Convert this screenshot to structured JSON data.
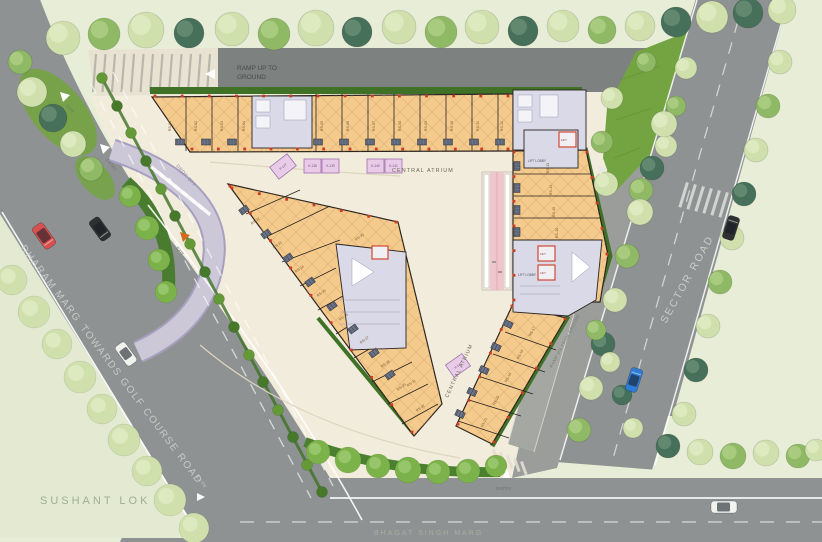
{
  "labels": {
    "ramp_up_line1": "RAMP UP TO",
    "ramp_up_line2": "GROUND",
    "ramp_dn": "RAMP DN FROM GROUND",
    "central_atrium_top": "CENTRAL ATRIUM",
    "central_atrium_mid": "CENTRAL ATRIUM",
    "dharam_marg": "DHARAM MARG",
    "towards_golf": "TOWARDS GOLF COURSE ROAD",
    "road_extn": "EXTN",
    "sector_road": "SECTOR ROAD",
    "sushant_lok": "SUSHANT LOK",
    "bhagat_singh_marg": "BHAGAT SINGH MARG",
    "drop_off": "DROP OFF",
    "entry_left": "ENTRY",
    "exit_top": "EXIT",
    "exit_drop": "EXIT",
    "entry_bottom": "ENTRY",
    "lift_lobby_right": "LIFT LOBBY",
    "lift_lobby_top": "LIFT LOBBY",
    "lift": "LIFT"
  },
  "colors": {
    "road_grey": "#8f9292",
    "road_dark": "#7d8180",
    "paving_cream": "#f2ecdc",
    "pale_green": "#e8edd8",
    "lawn_green": "#74a441",
    "hedge_green": "#3f7227",
    "shop_tan": "#f4ca8d",
    "core_lavender": "#d9d9e7",
    "kiosk_pink": "#e8cbe6",
    "escalator_pink": "#eec6cb",
    "dropoff_lavender": "#ccc8d8",
    "accent_red": "#cf3b23",
    "tones": {
      "pale": [
        "#cfe0ad",
        "#e2edc6"
      ],
      "light": [
        "#b7d38c",
        "#d3e5af"
      ],
      "mid": [
        "#8fb964",
        "#b1d28a"
      ],
      "dark": [
        "#5d8a50",
        "#7fa973"
      ],
      "teal": [
        "#47705a",
        "#6b9178"
      ],
      "bright": [
        "#7cb24a",
        "#a3cd79"
      ]
    },
    "median_bush_a": "#47792b",
    "median_bush_b": "#639a37"
  },
  "scene": {
    "units": [
      {
        "label": "RS-01",
        "x": 171,
        "y": 126,
        "rot": -90
      },
      {
        "label": "RS-02",
        "x": 197,
        "y": 126,
        "rot": -90
      },
      {
        "label": "RS-03",
        "x": 223,
        "y": 126,
        "rot": -90
      },
      {
        "label": "RS-04",
        "x": 245,
        "y": 126,
        "rot": -90
      },
      {
        "label": "RS-05",
        "x": 323,
        "y": 126,
        "rot": -90
      },
      {
        "label": "RS-06",
        "x": 349,
        "y": 126,
        "rot": -90
      },
      {
        "label": "RS-07",
        "x": 375,
        "y": 126,
        "rot": -90
      },
      {
        "label": "RS-08",
        "x": 401,
        "y": 126,
        "rot": -90
      },
      {
        "label": "RS-09",
        "x": 427,
        "y": 126,
        "rot": -90
      },
      {
        "label": "RS-10",
        "x": 453,
        "y": 126,
        "rot": -90
      },
      {
        "label": "RS-11",
        "x": 479,
        "y": 126,
        "rot": -90
      },
      {
        "label": "RS-12",
        "x": 503,
        "y": 126,
        "rot": -90
      },
      {
        "label": "RS-13",
        "x": 549,
        "y": 168,
        "rot": -90
      },
      {
        "label": "RS-14",
        "x": 552,
        "y": 190,
        "rot": -90
      },
      {
        "label": "RS-15",
        "x": 555,
        "y": 212,
        "rot": -90
      },
      {
        "label": "RS-16",
        "x": 558,
        "y": 233,
        "rot": -90
      },
      {
        "label": "RS-17",
        "x": 533,
        "y": 332,
        "rot": -62
      },
      {
        "label": "RS-18",
        "x": 521,
        "y": 355,
        "rot": -62
      },
      {
        "label": "RS-19",
        "x": 509,
        "y": 378,
        "rot": -62
      },
      {
        "label": "RS-20",
        "x": 497,
        "y": 401,
        "rot": -62
      },
      {
        "label": "RS-21",
        "x": 485,
        "y": 423,
        "rot": -62
      },
      {
        "label": "RS-22",
        "x": 256,
        "y": 222,
        "rot": -35
      },
      {
        "label": "RS-23",
        "x": 278,
        "y": 246,
        "rot": -35
      },
      {
        "label": "RS-24",
        "x": 300,
        "y": 270,
        "rot": -35
      },
      {
        "label": "RS-25",
        "x": 322,
        "y": 294,
        "rot": -35
      },
      {
        "label": "RS-26",
        "x": 344,
        "y": 318,
        "rot": -35
      },
      {
        "label": "RS-27",
        "x": 365,
        "y": 341,
        "rot": -35
      },
      {
        "label": "RS-28",
        "x": 386,
        "y": 365,
        "rot": -35
      },
      {
        "label": "RS-29",
        "x": 402,
        "y": 388,
        "rot": -35
      },
      {
        "label": "RS-30",
        "x": 360,
        "y": 238,
        "rot": -35
      },
      {
        "label": "RS-31",
        "x": 412,
        "y": 384,
        "rot": -35
      },
      {
        "label": "RS-32",
        "x": 421,
        "y": 409,
        "rot": -35
      }
    ],
    "kiosks": [
      {
        "label": "K-137",
        "x": 272,
        "y": 159,
        "w": 22,
        "h": 15,
        "rot": -38
      },
      {
        "label": "K-138",
        "x": 304,
        "y": 159,
        "w": 17,
        "h": 14,
        "rot": 0
      },
      {
        "label": "K-139",
        "x": 322,
        "y": 159,
        "w": 17,
        "h": 14,
        "rot": 0
      },
      {
        "label": "K-140",
        "x": 367,
        "y": 159,
        "w": 17,
        "h": 14,
        "rot": 0
      },
      {
        "label": "K-141",
        "x": 385,
        "y": 159,
        "w": 17,
        "h": 14,
        "rot": 0
      },
      {
        "label": "K-142",
        "x": 448,
        "y": 358,
        "w": 20,
        "h": 15,
        "rot": -35
      }
    ],
    "shutters": [
      [
        180,
        142,
        0
      ],
      [
        206,
        142,
        0
      ],
      [
        232,
        142,
        0
      ],
      [
        318,
        142,
        0
      ],
      [
        344,
        142,
        0
      ],
      [
        370,
        142,
        0
      ],
      [
        396,
        142,
        0
      ],
      [
        422,
        142,
        0
      ],
      [
        448,
        142,
        0
      ],
      [
        474,
        142,
        0
      ],
      [
        500,
        142,
        0
      ],
      [
        517,
        166,
        90
      ],
      [
        517,
        188,
        90
      ],
      [
        517,
        210,
        90
      ],
      [
        517,
        232,
        90
      ],
      [
        508,
        324,
        25
      ],
      [
        496,
        347,
        25
      ],
      [
        484,
        370,
        25
      ],
      [
        472,
        392,
        25
      ],
      [
        460,
        414,
        25
      ],
      [
        244,
        210,
        -36
      ],
      [
        266,
        234,
        -36
      ],
      [
        288,
        258,
        -36
      ],
      [
        310,
        282,
        -36
      ],
      [
        332,
        306,
        -36
      ],
      [
        353,
        329,
        -36
      ],
      [
        374,
        353,
        -36
      ],
      [
        390,
        375,
        -36
      ]
    ],
    "ticks": [
      {
        "x1": 155,
        "y1": 96,
        "x2": 508,
        "y2": 96,
        "n": 13
      },
      {
        "x1": 192,
        "y1": 149,
        "x2": 508,
        "y2": 149,
        "n": 12
      },
      {
        "x1": 514,
        "y1": 152,
        "x2": 514,
        "y2": 300,
        "n": 6
      },
      {
        "x1": 587,
        "y1": 152,
        "x2": 607,
        "y2": 254,
        "n": 4
      },
      {
        "x1": 230,
        "y1": 186,
        "x2": 412,
        "y2": 432,
        "n": 9
      },
      {
        "x1": 232,
        "y1": 188,
        "x2": 396,
        "y2": 222,
        "n": 6
      },
      {
        "x1": 458,
        "y1": 424,
        "x2": 512,
        "y2": 306,
        "n": 5
      },
      {
        "x1": 565,
        "y1": 319,
        "x2": 494,
        "y2": 442,
        "n": 5
      }
    ],
    "trees": [
      [
        63,
        38,
        17,
        "pale"
      ],
      [
        104,
        34,
        16,
        "mid"
      ],
      [
        146,
        30,
        18,
        "pale"
      ],
      [
        189,
        33,
        15,
        "teal"
      ],
      [
        232,
        29,
        17,
        "pale"
      ],
      [
        274,
        34,
        16,
        "mid"
      ],
      [
        316,
        28,
        18,
        "pale"
      ],
      [
        357,
        32,
        15,
        "teal"
      ],
      [
        399,
        27,
        17,
        "pale"
      ],
      [
        441,
        32,
        16,
        "mid"
      ],
      [
        482,
        27,
        17,
        "pale"
      ],
      [
        523,
        31,
        15,
        "teal"
      ],
      [
        563,
        26,
        16,
        "pale"
      ],
      [
        602,
        30,
        14,
        "mid"
      ],
      [
        640,
        26,
        15,
        "pale"
      ],
      [
        676,
        22,
        15,
        "teal"
      ],
      [
        712,
        17,
        16,
        "pale"
      ],
      [
        748,
        13,
        15,
        "teal"
      ],
      [
        782,
        10,
        14,
        "pale"
      ],
      [
        646,
        62,
        10,
        "mid"
      ],
      [
        666,
        146,
        11,
        "pale"
      ],
      [
        676,
        106,
        10,
        "mid"
      ],
      [
        686,
        68,
        11,
        "pale"
      ],
      [
        612,
        98,
        11,
        "pale"
      ],
      [
        602,
        142,
        11,
        "mid"
      ],
      [
        606,
        184,
        12,
        "pale"
      ],
      [
        641,
        190,
        12,
        "mid"
      ],
      [
        20,
        62,
        12,
        "mid"
      ],
      [
        32,
        92,
        15,
        "pale"
      ],
      [
        53,
        118,
        14,
        "teal"
      ],
      [
        73,
        144,
        13,
        "pale"
      ],
      [
        91,
        169,
        12,
        "mid"
      ],
      [
        664,
        124,
        13,
        "pale"
      ],
      [
        652,
        168,
        12,
        "teal"
      ],
      [
        640,
        212,
        13,
        "pale"
      ],
      [
        627,
        256,
        12,
        "mid"
      ],
      [
        615,
        300,
        12,
        "pale"
      ],
      [
        603,
        344,
        12,
        "teal"
      ],
      [
        591,
        388,
        12,
        "pale"
      ],
      [
        579,
        430,
        12,
        "mid"
      ],
      [
        780,
        62,
        12,
        "pale"
      ],
      [
        768,
        106,
        12,
        "mid"
      ],
      [
        756,
        150,
        12,
        "pale"
      ],
      [
        744,
        194,
        12,
        "teal"
      ],
      [
        732,
        238,
        12,
        "pale"
      ],
      [
        720,
        282,
        12,
        "mid"
      ],
      [
        708,
        326,
        12,
        "pale"
      ],
      [
        696,
        370,
        12,
        "teal"
      ],
      [
        684,
        414,
        12,
        "pale"
      ],
      [
        668,
        446,
        12,
        "teal"
      ],
      [
        700,
        452,
        13,
        "pale"
      ],
      [
        733,
        456,
        13,
        "mid"
      ],
      [
        766,
        453,
        13,
        "pale"
      ],
      [
        798,
        456,
        12,
        "mid"
      ],
      [
        816,
        450,
        11,
        "pale"
      ],
      [
        596,
        330,
        10,
        "mid"
      ],
      [
        610,
        362,
        10,
        "pale"
      ],
      [
        622,
        395,
        10,
        "teal"
      ],
      [
        633,
        428,
        10,
        "pale"
      ]
    ],
    "bushes": [
      [
        12,
        280,
        15,
        "pale"
      ],
      [
        34,
        312,
        16,
        "pale"
      ],
      [
        57,
        344,
        15,
        "pale"
      ],
      [
        80,
        377,
        16,
        "pale"
      ],
      [
        102,
        409,
        15,
        "pale"
      ],
      [
        124,
        440,
        16,
        "pale"
      ],
      [
        147,
        471,
        15,
        "pale"
      ],
      [
        170,
        500,
        16,
        "pale"
      ],
      [
        194,
        528,
        15,
        "pale"
      ],
      [
        318,
        452,
        12,
        "bright"
      ],
      [
        348,
        460,
        13,
        "bright"
      ],
      [
        378,
        466,
        12,
        "bright"
      ],
      [
        408,
        470,
        13,
        "bright"
      ],
      [
        438,
        472,
        12,
        "bright"
      ],
      [
        468,
        471,
        12,
        "bright"
      ],
      [
        496,
        466,
        11,
        "bright"
      ],
      [
        130,
        196,
        11,
        "bright"
      ],
      [
        147,
        228,
        12,
        "bright"
      ],
      [
        159,
        260,
        11,
        "bright"
      ],
      [
        166,
        292,
        11,
        "bright"
      ]
    ],
    "median_bushes": [
      [
        102,
        78
      ],
      [
        117,
        106
      ],
      [
        131,
        133
      ],
      [
        146,
        161
      ],
      [
        161,
        189
      ],
      [
        175,
        216
      ],
      [
        190,
        244
      ],
      [
        205,
        272
      ],
      [
        219,
        299
      ],
      [
        234,
        327
      ],
      [
        249,
        355
      ],
      [
        263,
        382
      ],
      [
        278,
        410
      ],
      [
        293,
        437
      ],
      [
        307,
        465
      ],
      [
        322,
        492
      ]
    ],
    "cars": [
      {
        "x": 44,
        "y": 236,
        "rot": 54,
        "body": "#d95050",
        "len": 26,
        "wid": 13
      },
      {
        "x": 100,
        "y": 229,
        "rot": 54,
        "body": "#2f3032",
        "len": 24,
        "wid": 12
      },
      {
        "x": 126,
        "y": 354,
        "rot": 54,
        "body": "#f1f1ee",
        "len": 24,
        "wid": 12
      },
      {
        "x": 731,
        "y": 228,
        "rot": -72,
        "body": "#2f3032",
        "len": 24,
        "wid": 12
      },
      {
        "x": 634,
        "y": 380,
        "rot": -72,
        "body": "#2e7cd6",
        "len": 24,
        "wid": 12
      },
      {
        "x": 724,
        "y": 507,
        "rot": 0,
        "body": "#f1f1ee",
        "len": 26,
        "wid": 12
      }
    ],
    "parking_stripes": {
      "x": 96,
      "y": 54,
      "n": 13,
      "dx": 9.5,
      "skew": -3,
      "h": 38
    },
    "zebras": [
      {
        "x": 150,
        "y": 168,
        "n": 7,
        "dx": 7.8,
        "dy": 6.3,
        "w": 3.5,
        "h": 16,
        "rot": -50,
        "color": "#ffffff",
        "opacity": 0.85
      },
      {
        "x": 492,
        "y": 450,
        "n": 5,
        "dx": 7,
        "dy": 3,
        "w": 3,
        "h": 14,
        "rot": -20,
        "color": "#e4ded0",
        "opacity": 0.9
      },
      {
        "x": 686,
        "y": 182,
        "n": 6,
        "dx": 8,
        "dy": 2,
        "w": 3,
        "h": 26,
        "rot": 17,
        "color": "#d9dcd6",
        "opacity": 0.9
      }
    ],
    "lift_boxes": [
      [
        559,
        132,
        17,
        15
      ],
      [
        538,
        246,
        17,
        15
      ],
      [
        538,
        265,
        17,
        15
      ],
      [
        372,
        246,
        16,
        13
      ]
    ]
  }
}
